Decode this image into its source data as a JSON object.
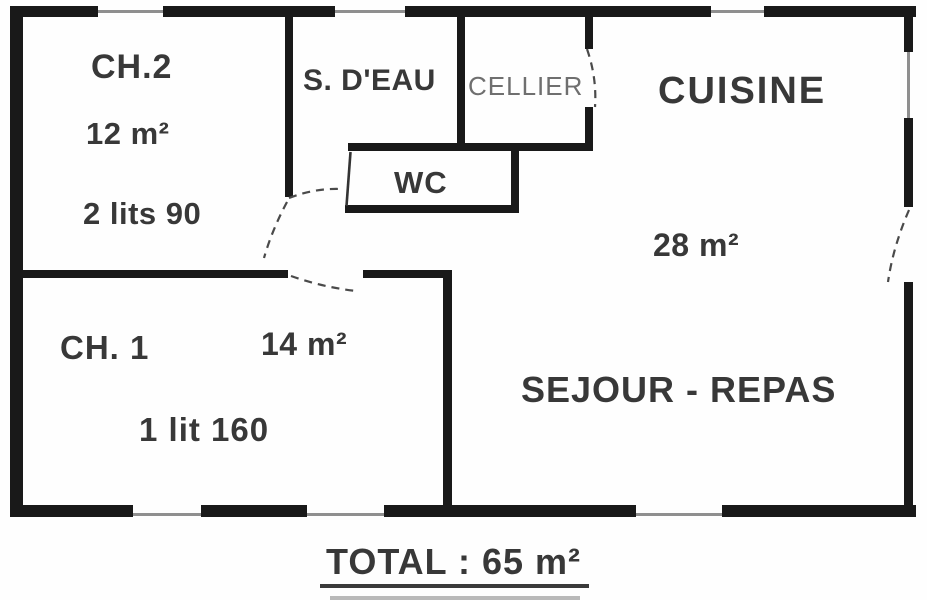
{
  "plan": {
    "type": "apartment-floor-plan",
    "rooms": [
      {
        "id": "ch2",
        "label": "CH.2",
        "area": "12 m²",
        "note": "2 lits 90"
      },
      {
        "id": "sdeau",
        "label": "S. D'EAU",
        "area": "",
        "note": ""
      },
      {
        "id": "cellier",
        "label": "CELLIER",
        "area": "",
        "note": ""
      },
      {
        "id": "wc",
        "label": "WC",
        "area": "",
        "note": ""
      },
      {
        "id": "cuisine",
        "label": "CUISINE",
        "area": "28 m²",
        "note": ""
      },
      {
        "id": "ch1",
        "label": "CH. 1",
        "area": "14 m²",
        "note": "1 lit 160"
      },
      {
        "id": "sejour",
        "label": "SEJOUR - REPAS",
        "area": "",
        "note": ""
      }
    ],
    "total_label": "TOTAL : 65 m²"
  },
  "colors": {
    "wall": "#191919",
    "text": "#383838",
    "muted_text": "#6f6f6f",
    "window_line": "#8f8f8f",
    "door_dash": "#4a4a4a",
    "background": "#fefefe"
  }
}
